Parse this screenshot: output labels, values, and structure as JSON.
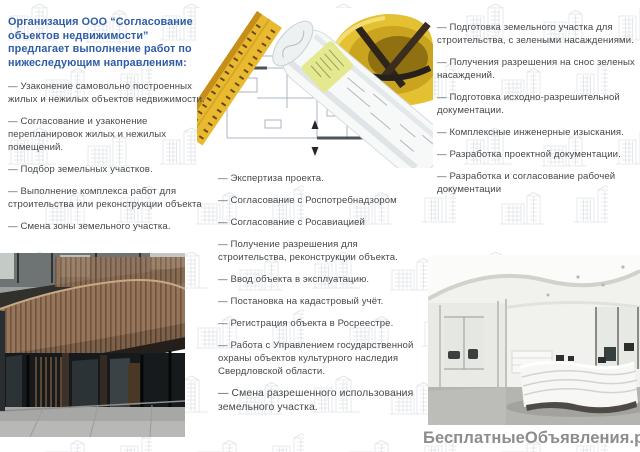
{
  "brochure": {
    "intro": "Организация ООО “Согласование объектов недвижимости” предлагает выполнение работ по нижеследующим направлениям:",
    "left_items": [
      "— Узаконение самовольно построенных жилых и нежилых объектов недвижимости.",
      "— Согласование и узаконение перепланировок жилых и нежилых помещений.",
      "— Подбор земельных участков.",
      "— Выполнение комплекса работ для строительства или реконструкции объекта",
      "— Смена зоны земельного участка."
    ],
    "middle_items": [
      "— Экспертиза проекта.",
      "— Согласование с Роспотребнадзором",
      "— Согласование с Росавиацией",
      "— Получение разрешения для строительства, реконструкции объекта.",
      "— Ввод объекта в эксплуатацию.",
      "— Постановка на кадастровый учёт.",
      "— Регистрация объекта в Росреестре.",
      "— Работа с Управлением государственной охраны объектов культурного наследия Свердловской области.",
      "— Смена разрешенного использования земельного участка."
    ],
    "right_items": [
      "— Подготовка земельного участка для строительства, с зелеными насаждениями.",
      "— Получения разрешения на снос зеленых насаждений.",
      "— Подготовка исходно-разрешительной документации.",
      "— Комплексные инженерные изыскания.",
      "— Разработка проектной документации.",
      "— Разработка и согласование рабочей документации"
    ],
    "watermark": "БесплатныеОбъявления.рф",
    "colors": {
      "accent": "#2e5ca6",
      "body_text": "#46494b",
      "watermark": "#8d8d8d",
      "ruler_yellow": "#e9ba2f",
      "hardhat_yellow": "#e4c133"
    },
    "photos": {
      "top": "blueprint-ruler-hardhat-photo",
      "bottom_left": "building-facade-photo",
      "bottom_right": "office-interior-photo"
    }
  }
}
